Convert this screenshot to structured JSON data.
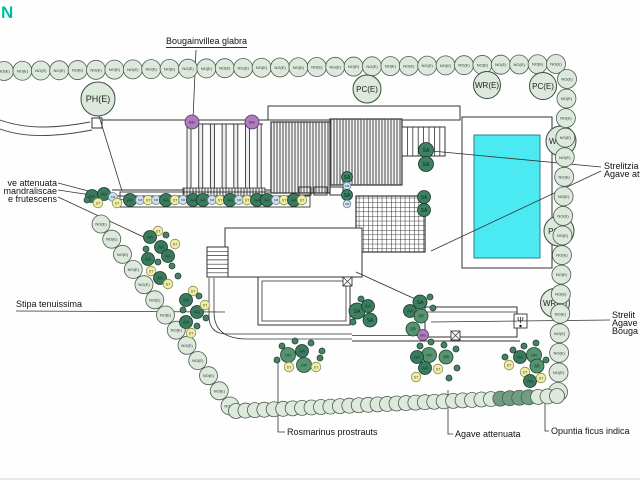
{
  "page": {
    "background": "#fefefe"
  },
  "title_fragment": {
    "text": "N",
    "color": "#00BCA3"
  },
  "hedge": {
    "circle_label": "NO(E)",
    "fill": "#dce9dc",
    "stroke": "#4d5c51",
    "dark_fill": "#6f9e80",
    "rows": [
      {
        "name": "hedge-row-top",
        "x1": 4,
        "y1": 71,
        "x2": 556,
        "y2": 64,
        "count": 31,
        "r": 9.5,
        "labeled": true,
        "dark_indices": []
      },
      {
        "name": "hedge-row-right",
        "x1": 567,
        "y1": 79,
        "x2": 558,
        "y2": 392,
        "count": 17,
        "r": 9.5,
        "labeled": true,
        "dark_indices": []
      },
      {
        "name": "hedge-row-left-diagonal",
        "x1": 101,
        "y1": 224,
        "x2": 230,
        "y2": 406,
        "count": 13,
        "r": 9,
        "labeled": true,
        "dark_indices": []
      },
      {
        "name": "hedge-row-bottom-scallop",
        "x1": 236,
        "y1": 411,
        "x2": 557,
        "y2": 396,
        "count": 35,
        "r": 7.5,
        "labeled": false,
        "dark_indices": [
          28,
          29,
          30,
          31
        ]
      }
    ]
  },
  "utility_circles": [
    {
      "label": "PH(E)",
      "x": 98,
      "y": 99,
      "r": 17,
      "font": 9,
      "under_hedge": false
    },
    {
      "label": "PC(E)",
      "x": 367,
      "y": 89,
      "r": 14,
      "font": 8,
      "under_hedge": false
    },
    {
      "label": "WR(E)",
      "x": 487,
      "y": 85,
      "r": 13.5,
      "font": 8,
      "under_hedge": false
    },
    {
      "label": "PC(E)",
      "x": 543,
      "y": 86,
      "r": 13.5,
      "font": 8,
      "under_hedge": false
    },
    {
      "label": "WR(E)",
      "x": 561,
      "y": 141,
      "r": 15,
      "font": 8,
      "under_hedge": true
    },
    {
      "label": "PC(E)",
      "x": 559,
      "y": 231,
      "r": 15,
      "font": 8,
      "under_hedge": true
    },
    {
      "label": "WR(E)",
      "x": 555,
      "y": 303,
      "r": 14.5,
      "font": 8,
      "under_hedge": true
    }
  ],
  "plants": {
    "types": {
      "AA": {
        "fill": "#3a7a5e",
        "stroke": "#173828",
        "text": "AA",
        "r": 6.5,
        "font": 4.5,
        "text_fill": "#06281a"
      },
      "SA": {
        "fill": "#3d8063",
        "stroke": "#173828",
        "text": "SA",
        "r": 7.5,
        "font": 5,
        "text_fill": "#06281a"
      },
      "OFI": {
        "fill": "#569470",
        "stroke": "#1d4430",
        "text": "OFI",
        "r": 7.5,
        "font": 3.8,
        "text_fill": "#0a2f1e"
      },
      "SR": {
        "fill": "#569470",
        "stroke": "#1d4430",
        "text": "SR",
        "r": 7,
        "font": 4.2,
        "text_fill": "#0a2f1e"
      },
      "ST": {
        "fill": "#efedaa",
        "stroke": "#8e8d4e",
        "text": "ST",
        "r": 4.8,
        "font": 3.5,
        "text_fill": "#4a4a16"
      },
      "SM": {
        "fill": "#cfe0ea",
        "stroke": "#6d8c9c",
        "text": "SM",
        "r": 4.5,
        "font": 3,
        "text_fill": "#2c4654"
      },
      "BG": {
        "fill": "#b07cc0",
        "stroke": "#54355f",
        "text": "BG",
        "r": 7,
        "font": 4,
        "text_fill": "#2c1233"
      },
      "dot": {
        "fill": "#4b8066",
        "stroke": "#1d4430",
        "text": "",
        "r": 3,
        "font": 3,
        "text_fill": "#000"
      }
    },
    "items": [
      {
        "t": "AA",
        "x": 130,
        "y": 200
      },
      {
        "t": "SM",
        "x": 140,
        "y": 200
      },
      {
        "t": "ST",
        "x": 148,
        "y": 200
      },
      {
        "t": "SM",
        "x": 156,
        "y": 200
      },
      {
        "t": "AA",
        "x": 166,
        "y": 200
      },
      {
        "t": "ST",
        "x": 175,
        "y": 200
      },
      {
        "t": "SM",
        "x": 183,
        "y": 200
      },
      {
        "t": "AA",
        "x": 193,
        "y": 200
      },
      {
        "t": "AA",
        "x": 203,
        "y": 200
      },
      {
        "t": "SM",
        "x": 212,
        "y": 200
      },
      {
        "t": "ST",
        "x": 220,
        "y": 200
      },
      {
        "t": "AA",
        "x": 230,
        "y": 200
      },
      {
        "t": "SM",
        "x": 239,
        "y": 200
      },
      {
        "t": "ST",
        "x": 247,
        "y": 200
      },
      {
        "t": "AA",
        "x": 257,
        "y": 200
      },
      {
        "t": "AA",
        "x": 267,
        "y": 200
      },
      {
        "t": "SM",
        "x": 276,
        "y": 200
      },
      {
        "t": "ST",
        "x": 284,
        "y": 200
      },
      {
        "t": "AA",
        "x": 294,
        "y": 200
      },
      {
        "t": "ST",
        "x": 302,
        "y": 200
      },
      {
        "t": "AA",
        "x": 92,
        "y": 196
      },
      {
        "t": "AA",
        "x": 104,
        "y": 194
      },
      {
        "t": "ST",
        "x": 98,
        "y": 203
      },
      {
        "t": "SM",
        "x": 113,
        "y": 197
      },
      {
        "t": "ST",
        "x": 117,
        "y": 203
      },
      {
        "t": "dot",
        "x": 87,
        "y": 200
      },
      {
        "t": "BG",
        "x": 192,
        "y": 122
      },
      {
        "t": "BG",
        "x": 252,
        "y": 122
      },
      {
        "t": "SA",
        "x": 426,
        "y": 150
      },
      {
        "t": "SA",
        "x": 426,
        "y": 164
      },
      {
        "t": "SA",
        "x": 424,
        "y": 197,
        "r": 6.5
      },
      {
        "t": "SA",
        "x": 424,
        "y": 210,
        "r": 6.5
      },
      {
        "t": "SA",
        "x": 347,
        "y": 177,
        "r": 5.5
      },
      {
        "t": "SM",
        "x": 347,
        "y": 186,
        "r": 3.8
      },
      {
        "t": "SA",
        "x": 347,
        "y": 195,
        "r": 5.5
      },
      {
        "t": "SM",
        "x": 347,
        "y": 204,
        "r": 3.8
      },
      {
        "t": "SA",
        "x": 357,
        "y": 311,
        "r": 8
      },
      {
        "t": "AA",
        "x": 368,
        "y": 306
      },
      {
        "t": "SA",
        "x": 370,
        "y": 320,
        "r": 7
      },
      {
        "t": "dot",
        "x": 361,
        "y": 299
      },
      {
        "t": "dot",
        "x": 353,
        "y": 322
      },
      {
        "t": "SA",
        "x": 420,
        "y": 302,
        "r": 7
      },
      {
        "t": "AA",
        "x": 410,
        "y": 311
      },
      {
        "t": "SR",
        "x": 421,
        "y": 316
      },
      {
        "t": "SR",
        "x": 413,
        "y": 329
      },
      {
        "t": "BG",
        "x": 423,
        "y": 335,
        "r": 5.5
      },
      {
        "t": "dot",
        "x": 430,
        "y": 297
      },
      {
        "t": "dot",
        "x": 433,
        "y": 308
      },
      {
        "t": "ST",
        "x": 158,
        "y": 231
      },
      {
        "t": "AA",
        "x": 150,
        "y": 237
      },
      {
        "t": "dot",
        "x": 166,
        "y": 235
      },
      {
        "t": "AA",
        "x": 161,
        "y": 247
      },
      {
        "t": "ST",
        "x": 175,
        "y": 244
      },
      {
        "t": "dot",
        "x": 146,
        "y": 249
      },
      {
        "t": "AA",
        "x": 148,
        "y": 259
      },
      {
        "t": "dot",
        "x": 158,
        "y": 262
      },
      {
        "t": "AA",
        "x": 168,
        "y": 256
      },
      {
        "t": "ST",
        "x": 151,
        "y": 271
      },
      {
        "t": "dot",
        "x": 172,
        "y": 266
      },
      {
        "t": "AA",
        "x": 160,
        "y": 278
      },
      {
        "t": "ST",
        "x": 168,
        "y": 284
      },
      {
        "t": "dot",
        "x": 178,
        "y": 276
      },
      {
        "t": "ST",
        "x": 193,
        "y": 291
      },
      {
        "t": "AA",
        "x": 186,
        "y": 300
      },
      {
        "t": "dot",
        "x": 199,
        "y": 296
      },
      {
        "t": "AA",
        "x": 197,
        "y": 312
      },
      {
        "t": "ST",
        "x": 205,
        "y": 305
      },
      {
        "t": "dot",
        "x": 183,
        "y": 310
      },
      {
        "t": "AA",
        "x": 186,
        "y": 322
      },
      {
        "t": "dot",
        "x": 197,
        "y": 326
      },
      {
        "t": "ST",
        "x": 191,
        "y": 333
      },
      {
        "t": "dot",
        "x": 206,
        "y": 318
      },
      {
        "t": "dot",
        "x": 282,
        "y": 346
      },
      {
        "t": "dot",
        "x": 295,
        "y": 341
      },
      {
        "t": "dot",
        "x": 311,
        "y": 343
      },
      {
        "t": "OFI",
        "x": 288,
        "y": 355
      },
      {
        "t": "AA",
        "x": 302,
        "y": 351
      },
      {
        "t": "dot",
        "x": 322,
        "y": 351
      },
      {
        "t": "OFI",
        "x": 304,
        "y": 365
      },
      {
        "t": "ST",
        "x": 289,
        "y": 367
      },
      {
        "t": "ST",
        "x": 316,
        "y": 367
      },
      {
        "t": "dot",
        "x": 320,
        "y": 358
      },
      {
        "t": "dot",
        "x": 277,
        "y": 360
      },
      {
        "t": "dot",
        "x": 420,
        "y": 346
      },
      {
        "t": "dot",
        "x": 431,
        "y": 342
      },
      {
        "t": "dot",
        "x": 444,
        "y": 345
      },
      {
        "t": "dot",
        "x": 456,
        "y": 349
      },
      {
        "t": "OFI",
        "x": 429,
        "y": 355
      },
      {
        "t": "AA",
        "x": 417,
        "y": 357
      },
      {
        "t": "SR",
        "x": 446,
        "y": 357
      },
      {
        "t": "AA",
        "x": 425,
        "y": 368
      },
      {
        "t": "ST",
        "x": 438,
        "y": 369
      },
      {
        "t": "ST",
        "x": 416,
        "y": 377
      },
      {
        "t": "dot",
        "x": 449,
        "y": 378
      },
      {
        "t": "dot",
        "x": 457,
        "y": 368
      },
      {
        "t": "dot",
        "x": 513,
        "y": 350
      },
      {
        "t": "dot",
        "x": 524,
        "y": 346
      },
      {
        "t": "dot",
        "x": 536,
        "y": 343
      },
      {
        "t": "AA",
        "x": 520,
        "y": 357
      },
      {
        "t": "OFI",
        "x": 534,
        "y": 355
      },
      {
        "t": "SR",
        "x": 537,
        "y": 366
      },
      {
        "t": "ST",
        "x": 509,
        "y": 365
      },
      {
        "t": "ST",
        "x": 525,
        "y": 372
      },
      {
        "t": "AA",
        "x": 530,
        "y": 381
      },
      {
        "t": "ST",
        "x": 541,
        "y": 378
      },
      {
        "t": "dot",
        "x": 546,
        "y": 360
      },
      {
        "t": "dot",
        "x": 505,
        "y": 357
      }
    ]
  },
  "labels": {
    "bougainvillea": {
      "text": "Bougainvillea glabra",
      "x": 166,
      "y": 36,
      "underline": true
    },
    "left_line1": {
      "text": "ve attenuata",
      "right": 57,
      "y": 178
    },
    "left_line2": {
      "text": "mandraliscae",
      "right": 57,
      "y": 186
    },
    "left_line3": {
      "text": "e frutescens",
      "right": 57,
      "y": 194
    },
    "stipa": {
      "text": "Stipa tenuissima",
      "x": 16,
      "y": 299
    },
    "rosmarinus": {
      "text": "Rosmarinus prostrauts",
      "x": 287,
      "y": 427
    },
    "agave_bottom": {
      "text": "Agave attenuata",
      "x": 455,
      "y": 429
    },
    "opuntia": {
      "text": "Opuntia ficus indica",
      "x": 551,
      "y": 426
    },
    "strelitzia_right": {
      "text": "Strelitzia a",
      "x": 604,
      "y": 161
    },
    "agave_right": {
      "text": "Agave att",
      "x": 604,
      "y": 169
    },
    "strelitzia_br": {
      "text": "Strelit",
      "x": 612,
      "y": 310
    },
    "agave_br": {
      "text": "Agave",
      "x": 612,
      "y": 318
    },
    "bougainvillea_br": {
      "text": "Bouga",
      "x": 612,
      "y": 326
    }
  },
  "leaders": [
    {
      "name": "leader-bougainvillea",
      "pts": [
        [
          196,
          50
        ],
        [
          193,
          119
        ]
      ]
    },
    {
      "name": "leader-ph",
      "pts": [
        [
          99,
          116
        ],
        [
          122,
          191
        ]
      ]
    },
    {
      "name": "leader-left-1",
      "pts": [
        [
          58,
          183
        ],
        [
          100,
          194
        ]
      ]
    },
    {
      "name": "leader-left-2",
      "pts": [
        [
          58,
          190
        ],
        [
          124,
          200
        ]
      ]
    },
    {
      "name": "leader-left-3",
      "pts": [
        [
          58,
          197
        ],
        [
          150,
          240
        ]
      ]
    },
    {
      "name": "leader-stipa",
      "pts": [
        [
          16,
          311
        ],
        [
          225,
          312
        ]
      ]
    },
    {
      "name": "leader-rosmarinus",
      "pts": [
        [
          278,
          362
        ],
        [
          278,
          432
        ],
        [
          285,
          432
        ]
      ]
    },
    {
      "name": "leader-agave-bottom",
      "pts": [
        [
          448,
          390
        ],
        [
          448,
          434
        ],
        [
          453,
          434
        ]
      ]
    },
    {
      "name": "leader-opuntia",
      "pts": [
        [
          545,
          398
        ],
        [
          545,
          431
        ],
        [
          549,
          431
        ]
      ]
    },
    {
      "name": "leader-strelitzia-right",
      "pts": [
        [
          601,
          167
        ],
        [
          432,
          151
        ]
      ]
    },
    {
      "name": "leader-agave-right",
      "pts": [
        [
          601,
          171
        ],
        [
          431,
          251
        ]
      ]
    },
    {
      "name": "leader-bottom-right",
      "pts": [
        [
          610,
          320
        ],
        [
          431,
          322
        ]
      ]
    }
  ],
  "pool": {
    "water_fill": "#4BEAF2",
    "water_stroke": "#2b7f8c"
  }
}
